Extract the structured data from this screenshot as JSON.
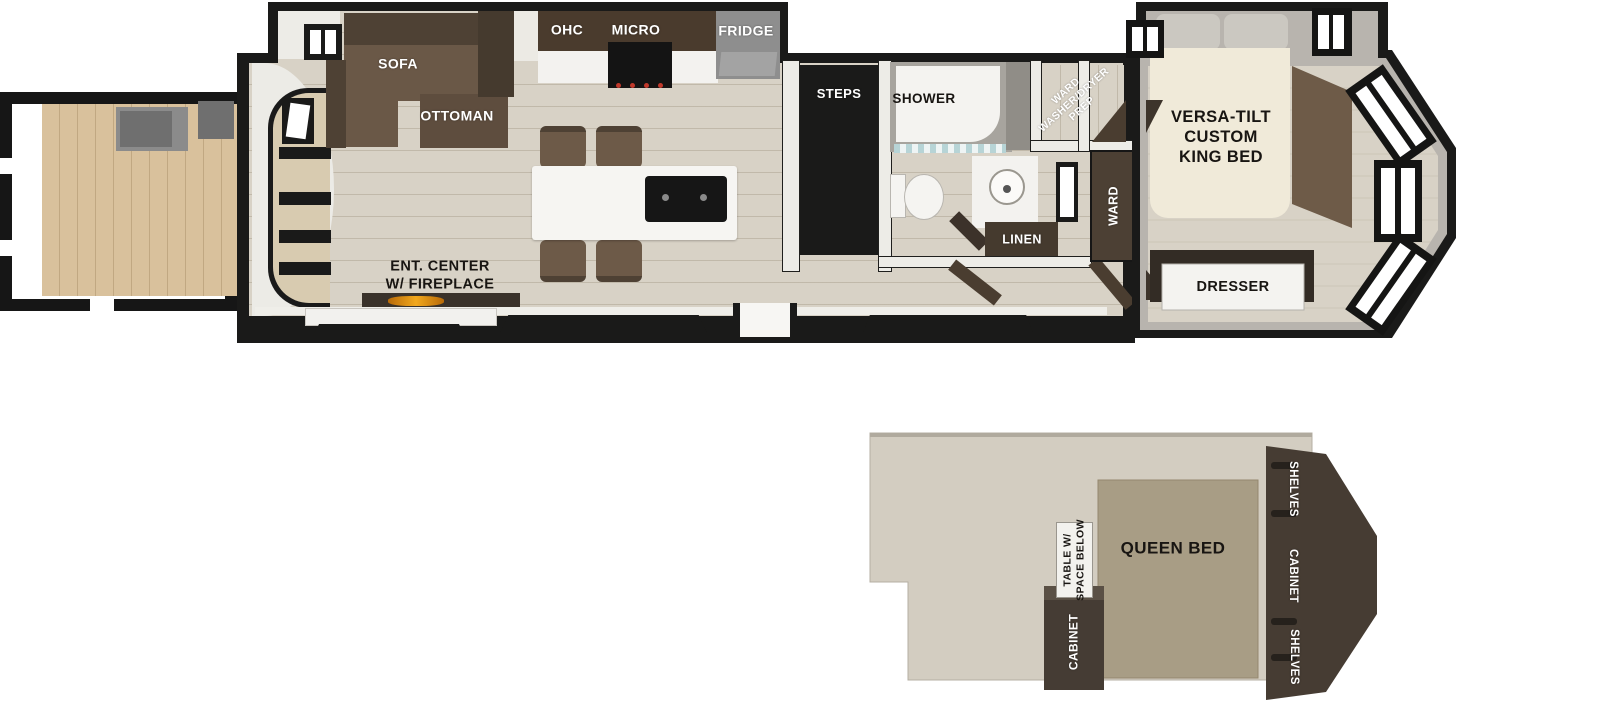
{
  "labels": {
    "sofa": "SOFA",
    "ottoman": "OTTOMAN",
    "ohc": "OHC",
    "micro": "MICRO",
    "fridge": "FRIDGE",
    "steps": "STEPS",
    "shower": "SHOWER",
    "washer_dryer_prep": "WARD\nWASHER/DRYER\nPREP",
    "king_bed": "VERSA-TILT\nCUSTOM\nKING BED",
    "linen": "LINEN",
    "ward": "WARD",
    "ent_center": "ENT. CENTER\nW/ FIREPLACE",
    "dresser": "DRESSER",
    "queen_bed": "QUEEN BED",
    "table": "TABLE W/\nSPACE BELOW",
    "cabinet_left": "CABINET",
    "shelves_top": "SHELVES",
    "cabinet_right": "CABINET",
    "shelves_bottom": "SHELVES"
  },
  "colors": {
    "outline": "#1a1a19",
    "floor_wood": "#d8d2c6",
    "deck_wood": "#d9c19c",
    "dark_cabinet": "#453a2e",
    "sofa_brown": "#6a5847",
    "fridge_gray": "#8e8e8e",
    "flame_orange": "#f2a81d",
    "queen_bed_tan": "#a89d85",
    "loft_floor": "#d3cdc1",
    "wall_gray": "#b8b4ae"
  }
}
